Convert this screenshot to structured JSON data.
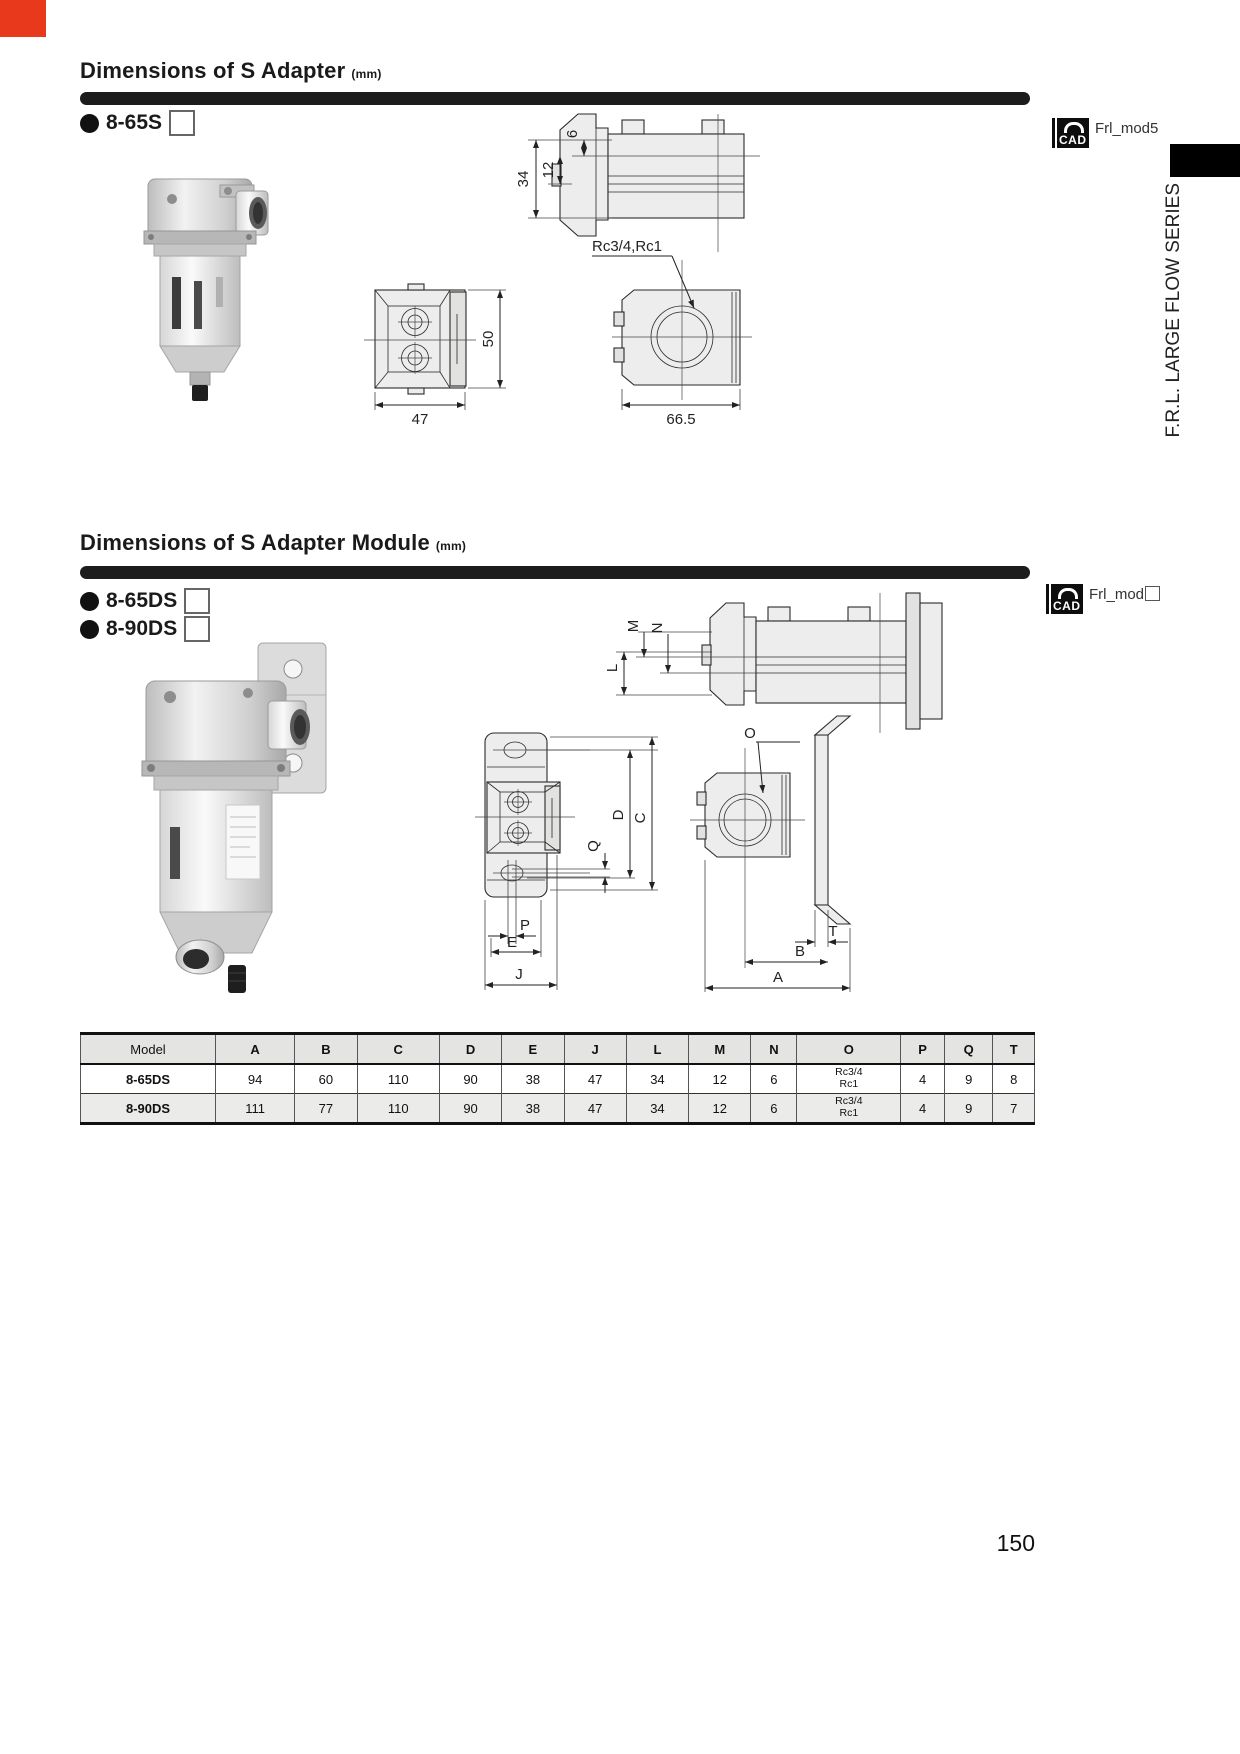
{
  "page": {
    "number": "150",
    "series_label": "F.R.L. LARGE FLOW SERIES"
  },
  "section1": {
    "title": "Dimensions of S Adapter",
    "unit": "(mm)",
    "model": "8-65S",
    "cad": {
      "icon": "CAD",
      "file": "Frl_mod5"
    },
    "dims": {
      "top_small": "6",
      "top_mid": "12",
      "top_total": "34",
      "front_height": "50",
      "front_width": "47",
      "side_width": "66.5",
      "port_label": "Rc3/4,Rc1"
    }
  },
  "section2": {
    "title": "Dimensions of S Adapter Module",
    "unit": "(mm)",
    "models": [
      "8-65DS",
      "8-90DS"
    ],
    "cad": {
      "icon": "CAD",
      "file": "Frl_mod"
    },
    "dim_letters": {
      "M": "M",
      "N": "N",
      "L": "L",
      "O": "O",
      "D": "D",
      "C": "C",
      "Q": "Q",
      "P": "P",
      "E": "E",
      "J": "J",
      "T": "T",
      "B": "B",
      "A": "A"
    }
  },
  "table": {
    "headers": [
      "Model",
      "A",
      "B",
      "C",
      "D",
      "E",
      "J",
      "L",
      "M",
      "N",
      "O",
      "P",
      "Q",
      "T"
    ],
    "rows": [
      {
        "model": "8-65DS",
        "values": [
          "94",
          "60",
          "110",
          "90",
          "38",
          "47",
          "34",
          "12",
          "6",
          "Rc3/4\nRc1",
          "4",
          "9",
          "8"
        ]
      },
      {
        "model": "8-90DS",
        "values": [
          "111",
          "77",
          "110",
          "90",
          "38",
          "47",
          "34",
          "12",
          "6",
          "Rc3/4\nRc1",
          "4",
          "9",
          "7"
        ]
      }
    ]
  }
}
